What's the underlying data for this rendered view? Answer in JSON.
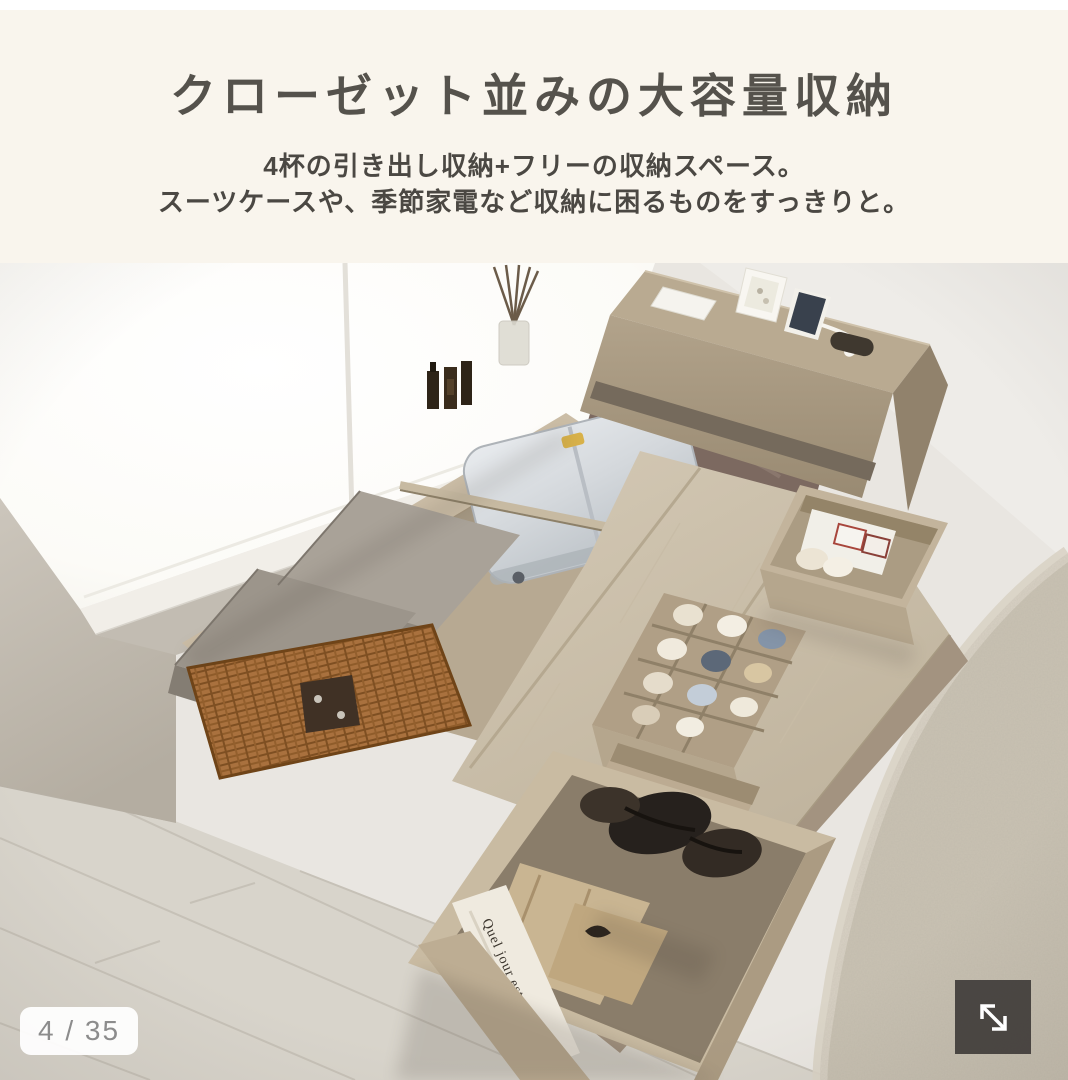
{
  "header": {
    "title": "クローゼット並みの大容量収納",
    "subtitle_lines": [
      "4杯の引き出し収納+フリーの収納スペース。",
      "スーツケースや、季節家電など収納に困るものをすっきりと。"
    ]
  },
  "photo": {
    "bag_text": "Quel jour est-ce"
  },
  "pagination": {
    "text": "4 / 35"
  },
  "controls": {
    "expand_icon": "expand-arrows"
  },
  "colors": {
    "header_bg": "#f9f5ed",
    "title_text": "#55524c",
    "subtitle_text": "#4b4843",
    "badge_bg": "#ffffff",
    "badge_text": "#8c8c8c",
    "expand_button_bg": "#403c39",
    "expand_arrow": "#ffffff",
    "wall": "#e9e6e1",
    "window": "#fdfdfa",
    "wood_frame": "#ae9f87",
    "deck_wood": "#cdc2ae",
    "suitcase": "#d9dcdf",
    "wicker_basket": "#a9713e",
    "rug": "#c9c2b3",
    "floor": "#d8d4cb"
  }
}
